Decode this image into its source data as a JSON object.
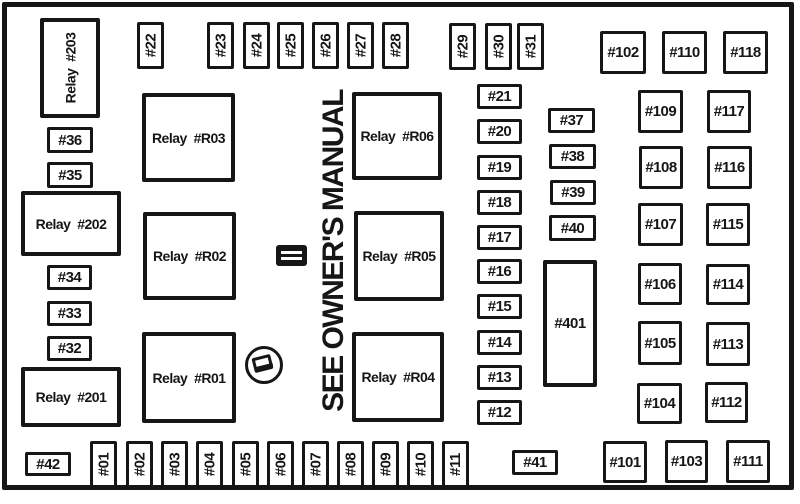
{
  "diagram": {
    "note_text": "SEE OWNER'S MANUAL",
    "icons": [
      {
        "id": "fuse-symbol-icon"
      },
      {
        "id": "fuse-puller-icon"
      }
    ],
    "boxes": [
      {
        "id": "relay-203",
        "label": "Relay  #203",
        "kind": "vrelay",
        "x": 40,
        "y": 18,
        "w": 60,
        "h": 100
      },
      {
        "id": "fuse-36",
        "label": "#36",
        "kind": "fuse",
        "x": 47,
        "y": 127,
        "w": 46,
        "h": 26
      },
      {
        "id": "fuse-35",
        "label": "#35",
        "kind": "fuse",
        "x": 47,
        "y": 162,
        "w": 46,
        "h": 26
      },
      {
        "id": "relay-202",
        "label": "Relay  #202",
        "kind": "relay",
        "x": 21,
        "y": 191,
        "w": 100,
        "h": 65
      },
      {
        "id": "fuse-34",
        "label": "#34",
        "kind": "fuse",
        "x": 47,
        "y": 265,
        "w": 45,
        "h": 25
      },
      {
        "id": "fuse-33",
        "label": "#33",
        "kind": "fuse",
        "x": 47,
        "y": 301,
        "w": 45,
        "h": 25
      },
      {
        "id": "fuse-32",
        "label": "#32",
        "kind": "fuse",
        "x": 47,
        "y": 336,
        "w": 45,
        "h": 25
      },
      {
        "id": "relay-201",
        "label": "Relay  #201",
        "kind": "relay",
        "x": 21,
        "y": 367,
        "w": 100,
        "h": 60
      },
      {
        "id": "fuse-42",
        "label": "#42",
        "kind": "fuse",
        "x": 25,
        "y": 452,
        "w": 46,
        "h": 24
      },
      {
        "id": "fuse-22",
        "label": "#22",
        "kind": "vfuse",
        "x": 137,
        "y": 22,
        "w": 27,
        "h": 47
      },
      {
        "id": "fuse-23",
        "label": "#23",
        "kind": "vfuse",
        "x": 207,
        "y": 22,
        "w": 27,
        "h": 47
      },
      {
        "id": "fuse-24",
        "label": "#24",
        "kind": "vfuse",
        "x": 243,
        "y": 22,
        "w": 27,
        "h": 47
      },
      {
        "id": "fuse-25",
        "label": "#25",
        "kind": "vfuse",
        "x": 277,
        "y": 22,
        "w": 27,
        "h": 47
      },
      {
        "id": "fuse-26",
        "label": "#26",
        "kind": "vfuse",
        "x": 312,
        "y": 22,
        "w": 27,
        "h": 47
      },
      {
        "id": "fuse-27",
        "label": "#27",
        "kind": "vfuse",
        "x": 347,
        "y": 22,
        "w": 27,
        "h": 47
      },
      {
        "id": "fuse-28",
        "label": "#28",
        "kind": "vfuse",
        "x": 382,
        "y": 22,
        "w": 27,
        "h": 47
      },
      {
        "id": "fuse-29",
        "label": "#29",
        "kind": "vfuse",
        "x": 449,
        "y": 23,
        "w": 27,
        "h": 47
      },
      {
        "id": "fuse-30",
        "label": "#30",
        "kind": "vfuse",
        "x": 485,
        "y": 23,
        "w": 27,
        "h": 47
      },
      {
        "id": "fuse-31",
        "label": "#31",
        "kind": "vfuse",
        "x": 517,
        "y": 23,
        "w": 27,
        "h": 47
      },
      {
        "id": "relay-r03",
        "label": "Relay  #R03",
        "kind": "relay",
        "x": 142,
        "y": 93,
        "w": 93,
        "h": 89
      },
      {
        "id": "relay-r02",
        "label": "Relay  #R02",
        "kind": "relay",
        "x": 143,
        "y": 212,
        "w": 93,
        "h": 88
      },
      {
        "id": "relay-r01",
        "label": "Relay  #R01",
        "kind": "relay",
        "x": 142,
        "y": 332,
        "w": 94,
        "h": 91
      },
      {
        "id": "relay-r06",
        "label": "Relay  #R06",
        "kind": "relay",
        "x": 352,
        "y": 92,
        "w": 90,
        "h": 88
      },
      {
        "id": "relay-r05",
        "label": "Relay  #R05",
        "kind": "relay",
        "x": 354,
        "y": 211,
        "w": 90,
        "h": 90
      },
      {
        "id": "relay-r04",
        "label": "Relay  #R04",
        "kind": "relay",
        "x": 352,
        "y": 332,
        "w": 92,
        "h": 90
      },
      {
        "id": "fuse-21",
        "label": "#21",
        "kind": "fuse",
        "x": 477,
        "y": 84,
        "w": 45,
        "h": 25
      },
      {
        "id": "fuse-20",
        "label": "#20",
        "kind": "fuse",
        "x": 477,
        "y": 119,
        "w": 45,
        "h": 25
      },
      {
        "id": "fuse-19",
        "label": "#19",
        "kind": "fuse",
        "x": 477,
        "y": 155,
        "w": 45,
        "h": 25
      },
      {
        "id": "fuse-18",
        "label": "#18",
        "kind": "fuse",
        "x": 477,
        "y": 190,
        "w": 45,
        "h": 25
      },
      {
        "id": "fuse-17",
        "label": "#17",
        "kind": "fuse",
        "x": 477,
        "y": 225,
        "w": 45,
        "h": 25
      },
      {
        "id": "fuse-16",
        "label": "#16",
        "kind": "fuse",
        "x": 477,
        "y": 259,
        "w": 45,
        "h": 25
      },
      {
        "id": "fuse-15",
        "label": "#15",
        "kind": "fuse",
        "x": 477,
        "y": 294,
        "w": 45,
        "h": 25
      },
      {
        "id": "fuse-14",
        "label": "#14",
        "kind": "fuse",
        "x": 477,
        "y": 330,
        "w": 45,
        "h": 25
      },
      {
        "id": "fuse-13",
        "label": "#13",
        "kind": "fuse",
        "x": 477,
        "y": 365,
        "w": 45,
        "h": 25
      },
      {
        "id": "fuse-12",
        "label": "#12",
        "kind": "fuse",
        "x": 477,
        "y": 400,
        "w": 45,
        "h": 25
      },
      {
        "id": "fuse-37",
        "label": "#37",
        "kind": "fuse",
        "x": 548,
        "y": 108,
        "w": 47,
        "h": 25
      },
      {
        "id": "fuse-38",
        "label": "#38",
        "kind": "fuse",
        "x": 549,
        "y": 144,
        "w": 47,
        "h": 25
      },
      {
        "id": "fuse-39",
        "label": "#39",
        "kind": "fuse",
        "x": 550,
        "y": 180,
        "w": 46,
        "h": 25
      },
      {
        "id": "fuse-40",
        "label": "#40",
        "kind": "fuse",
        "x": 549,
        "y": 215,
        "w": 47,
        "h": 26
      },
      {
        "id": "fuse-401",
        "label": "#401",
        "kind": "tall",
        "x": 543,
        "y": 260,
        "w": 54,
        "h": 127
      },
      {
        "id": "fuse-102",
        "label": "#102",
        "kind": "fuse",
        "x": 600,
        "y": 31,
        "w": 46,
        "h": 43
      },
      {
        "id": "fuse-110",
        "label": "#110",
        "kind": "fuse",
        "x": 662,
        "y": 31,
        "w": 45,
        "h": 43
      },
      {
        "id": "fuse-118",
        "label": "#118",
        "kind": "fuse",
        "x": 723,
        "y": 31,
        "w": 45,
        "h": 43
      },
      {
        "id": "fuse-109",
        "label": "#109",
        "kind": "fuse",
        "x": 638,
        "y": 90,
        "w": 45,
        "h": 43
      },
      {
        "id": "fuse-117",
        "label": "#117",
        "kind": "fuse",
        "x": 707,
        "y": 90,
        "w": 44,
        "h": 43
      },
      {
        "id": "fuse-108",
        "label": "#108",
        "kind": "fuse",
        "x": 639,
        "y": 146,
        "w": 44,
        "h": 43
      },
      {
        "id": "fuse-116",
        "label": "#116",
        "kind": "fuse",
        "x": 707,
        "y": 146,
        "w": 45,
        "h": 43
      },
      {
        "id": "fuse-107",
        "label": "#107",
        "kind": "fuse",
        "x": 638,
        "y": 203,
        "w": 45,
        "h": 43
      },
      {
        "id": "fuse-115",
        "label": "#115",
        "kind": "fuse",
        "x": 706,
        "y": 203,
        "w": 44,
        "h": 43
      },
      {
        "id": "fuse-106",
        "label": "#106",
        "kind": "fuse",
        "x": 638,
        "y": 263,
        "w": 44,
        "h": 42
      },
      {
        "id": "fuse-114",
        "label": "#114",
        "kind": "fuse",
        "x": 706,
        "y": 264,
        "w": 44,
        "h": 41
      },
      {
        "id": "fuse-105",
        "label": "#105",
        "kind": "fuse",
        "x": 638,
        "y": 321,
        "w": 44,
        "h": 44
      },
      {
        "id": "fuse-113",
        "label": "#113",
        "kind": "fuse",
        "x": 706,
        "y": 322,
        "w": 44,
        "h": 44
      },
      {
        "id": "fuse-104",
        "label": "#104",
        "kind": "fuse",
        "x": 637,
        "y": 383,
        "w": 45,
        "h": 41
      },
      {
        "id": "fuse-112",
        "label": "#112",
        "kind": "fuse",
        "x": 705,
        "y": 382,
        "w": 43,
        "h": 41
      },
      {
        "id": "fuse-01",
        "label": "#01",
        "kind": "vfuse",
        "x": 90,
        "y": 441,
        "w": 27,
        "h": 47
      },
      {
        "id": "fuse-02",
        "label": "#02",
        "kind": "vfuse",
        "x": 126,
        "y": 441,
        "w": 27,
        "h": 47
      },
      {
        "id": "fuse-03",
        "label": "#03",
        "kind": "vfuse",
        "x": 161,
        "y": 441,
        "w": 27,
        "h": 47
      },
      {
        "id": "fuse-04",
        "label": "#04",
        "kind": "vfuse",
        "x": 196,
        "y": 441,
        "w": 27,
        "h": 47
      },
      {
        "id": "fuse-05",
        "label": "#05",
        "kind": "vfuse",
        "x": 232,
        "y": 441,
        "w": 27,
        "h": 47
      },
      {
        "id": "fuse-06",
        "label": "#06",
        "kind": "vfuse",
        "x": 267,
        "y": 441,
        "w": 27,
        "h": 47
      },
      {
        "id": "fuse-07",
        "label": "#07",
        "kind": "vfuse",
        "x": 302,
        "y": 441,
        "w": 27,
        "h": 47
      },
      {
        "id": "fuse-08",
        "label": "#08",
        "kind": "vfuse",
        "x": 337,
        "y": 441,
        "w": 27,
        "h": 47
      },
      {
        "id": "fuse-09",
        "label": "#09",
        "kind": "vfuse",
        "x": 372,
        "y": 441,
        "w": 27,
        "h": 47
      },
      {
        "id": "fuse-10",
        "label": "#10",
        "kind": "vfuse",
        "x": 407,
        "y": 441,
        "w": 27,
        "h": 47
      },
      {
        "id": "fuse-11",
        "label": "#11",
        "kind": "vfuse",
        "x": 442,
        "y": 441,
        "w": 27,
        "h": 47
      },
      {
        "id": "fuse-41",
        "label": "#41",
        "kind": "fuse",
        "x": 512,
        "y": 450,
        "w": 46,
        "h": 25
      },
      {
        "id": "fuse-101",
        "label": "#101",
        "kind": "fuse",
        "x": 603,
        "y": 441,
        "w": 44,
        "h": 42
      },
      {
        "id": "fuse-103",
        "label": "#103",
        "kind": "fuse",
        "x": 665,
        "y": 440,
        "w": 43,
        "h": 43
      },
      {
        "id": "fuse-111",
        "label": "#111",
        "kind": "fuse",
        "x": 726,
        "y": 440,
        "w": 44,
        "h": 43
      }
    ]
  }
}
